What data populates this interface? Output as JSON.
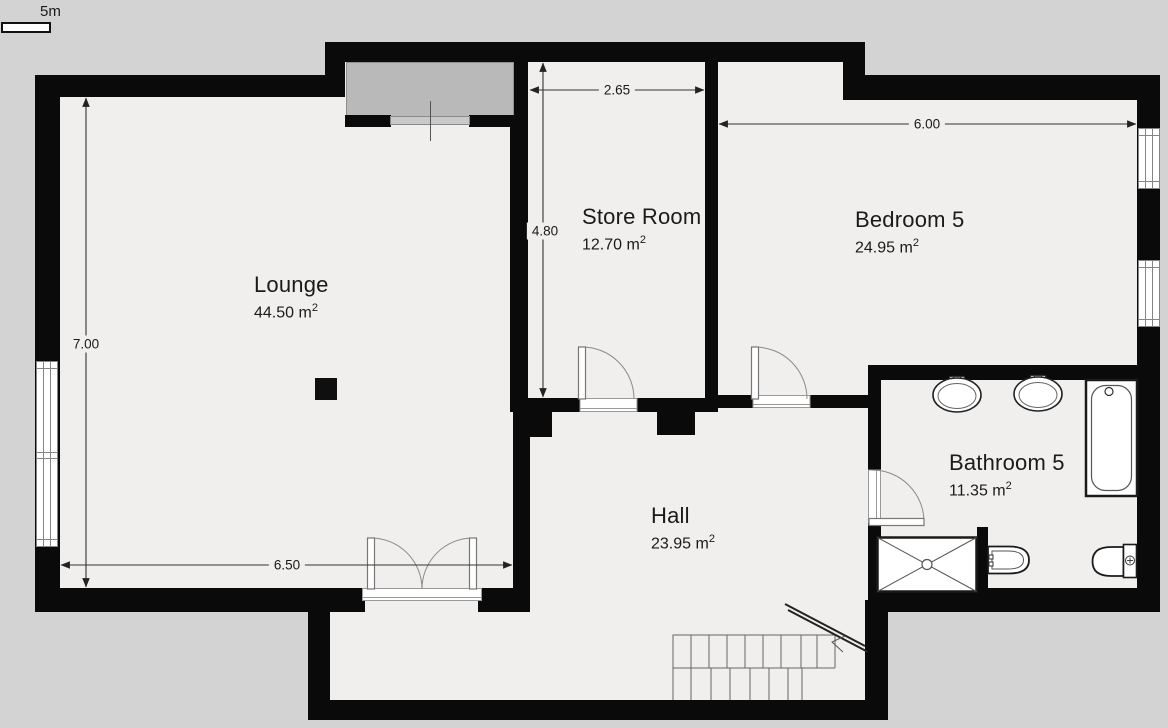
{
  "plan": {
    "scale_label": "5m",
    "rooms": [
      {
        "name": "Lounge",
        "area": "44.50 m",
        "area_sup": "2"
      },
      {
        "name": "Store Room",
        "area": "12.70 m",
        "area_sup": "2"
      },
      {
        "name": "Bedroom 5",
        "area": "24.95 m",
        "area_sup": "2"
      },
      {
        "name": "Bathroom 5",
        "area": "11.35 m",
        "area_sup": "2"
      },
      {
        "name": "Hall",
        "area": "23.95 m",
        "area_sup": "2"
      }
    ],
    "dimensions": {
      "store_room_width": "2.65",
      "store_room_depth": "4.80",
      "bedroom_width": "6.00",
      "lounge_depth": "7.00",
      "lounge_width": "6.50"
    },
    "colors": {
      "wall": "#0a0a0a",
      "floor": "#f0efed",
      "outside": "#d3d3d3",
      "fireplace": "#b9b9b9",
      "fixture_stroke": "#333333"
    }
  }
}
